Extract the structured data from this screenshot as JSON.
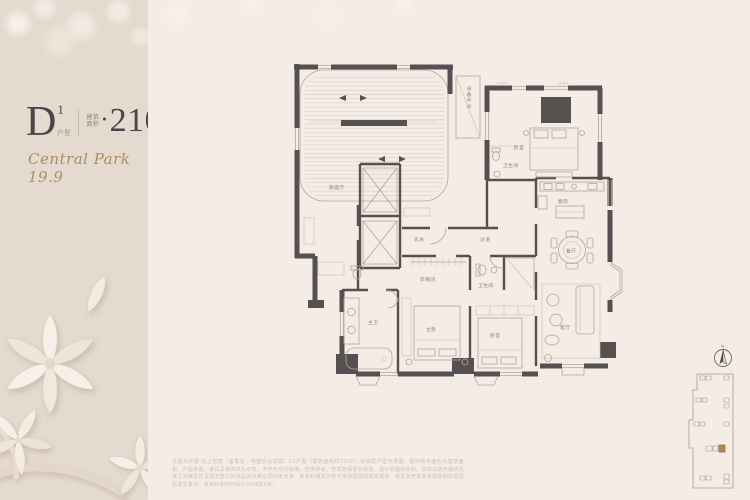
{
  "panel": {
    "unit_code": "D",
    "unit_sup": "1",
    "unit_caption": "户型",
    "area_caption_top": "建筑",
    "area_caption_bottom": "面积",
    "bullet": "●",
    "area_value": "210",
    "area_unit": "㎡",
    "brand_script": "Central Park 19.9"
  },
  "floorplan": {
    "labels": {
      "family_room": "家庭厅",
      "foyer": "玄关",
      "hallway": "过道",
      "equipment": "设备平台",
      "bedroom_top": "卧室",
      "bath_top": "卫生间",
      "kitchen": "厨房",
      "dining": "餐厅",
      "living": "客厅",
      "master_bath": "主卫",
      "master_bed": "主卧",
      "bedroom_2": "卧室",
      "bath_2": "卫生间",
      "cloakroom": "衣帽间"
    }
  },
  "keyplan": {
    "north_label": "N"
  },
  "disclaimer": {
    "text": "本图为中建·玖上璟宸（备案名：中建玖合璟宸）D1户型（建筑面积约210㎡）标准层户型示意图，图中所示面积为建筑面积，户型布置、家具及装饰仅为示意，不作为交付标准，仅供参考。开发商保留对规划、设计调整的权利，具体以政府最终批准之法律文件及双方签订的商品房买卖合同约定为准。本资料相关内容不排除因政府相关规划、规定及开发商未能控制的原因而发生变化。本资料制作时间为2025年5月。"
  },
  "colors": {
    "accent_gold": "#aa8f60",
    "wall": "#565151",
    "panel_bg": "#e5dacf",
    "canvas_bg": "#f4ece5"
  }
}
